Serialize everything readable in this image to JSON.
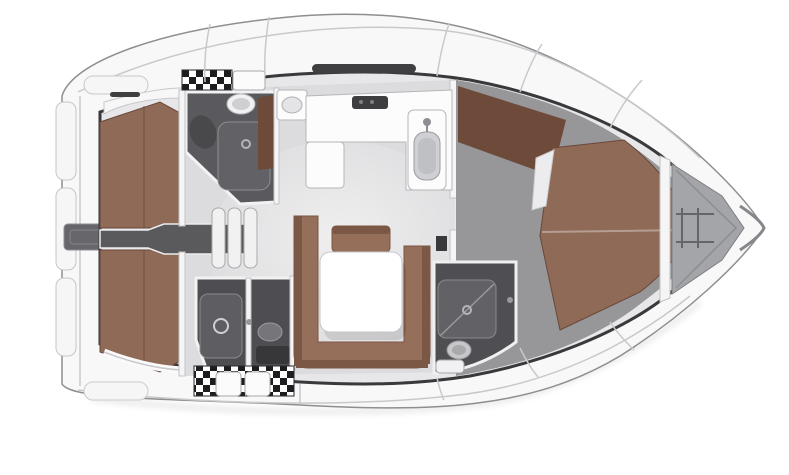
{
  "diagram": {
    "kind": "sailing-yacht-interior-floorplan",
    "orientation": "bow-right"
  },
  "areas": {
    "boat": "Sailing yacht interior layout, top view",
    "hull": "Hull and side decks",
    "transom": "Transom / stern platform",
    "engine_hatch": "Stern hatch",
    "aft_cabin_port": "Aft double cabin (port)",
    "aft_cabin_starboard": "Aft double cabin (starboard)",
    "companionway": "Companionway steps",
    "aft_head_port": "Aft head with shower (port)",
    "aft_head_starboard": "Aft head with shower (starboard)",
    "salon": "Salon",
    "galley": "Galley with stove and sink",
    "dinette": "U-shaped settee with salon table",
    "mast": "Mast post",
    "forward_cabin": "Forward cabin with double berth",
    "forward_head": "Forward head with shower",
    "bow_locker": "Bow anchor locker"
  },
  "colors": {
    "hull": "#f8f8f9",
    "hull_stroke": "#8e8e91",
    "cavity": "#e7e7e9",
    "cut_edge": "#39393c",
    "salon_floor": "#dcdcde",
    "fwd_floor": "#97979a",
    "head_floor": "#5a5a5e",
    "head_floor_dark": "#4e4e52",
    "berth": "#8e6a57",
    "berth_dark": "#6d4a3a",
    "settee": "#966f5b",
    "settee_dark": "#7b5745",
    "table": "#ffffff",
    "counter": "#fcfcfd",
    "companionway": "#5a5a5d",
    "step": "#f1f1f2",
    "slot": "#3f3f42",
    "wall": "#f5f5f6",
    "locker": "#a4a5a8",
    "engine_hatch": "#67676b",
    "fixture": "#f1f1f3",
    "steel": "#8f8f93",
    "shower": "#626266",
    "shower_dark": "#5e5e62",
    "toilet_dark": "#75757a",
    "basin": "#cfd0d3",
    "seat_dark": "#49494c",
    "mast": "#39393c",
    "panel": "#f6f6f7",
    "stove": "#3e3e41",
    "shelf": "#f7f7f8",
    "pillow": "#ececee"
  }
}
